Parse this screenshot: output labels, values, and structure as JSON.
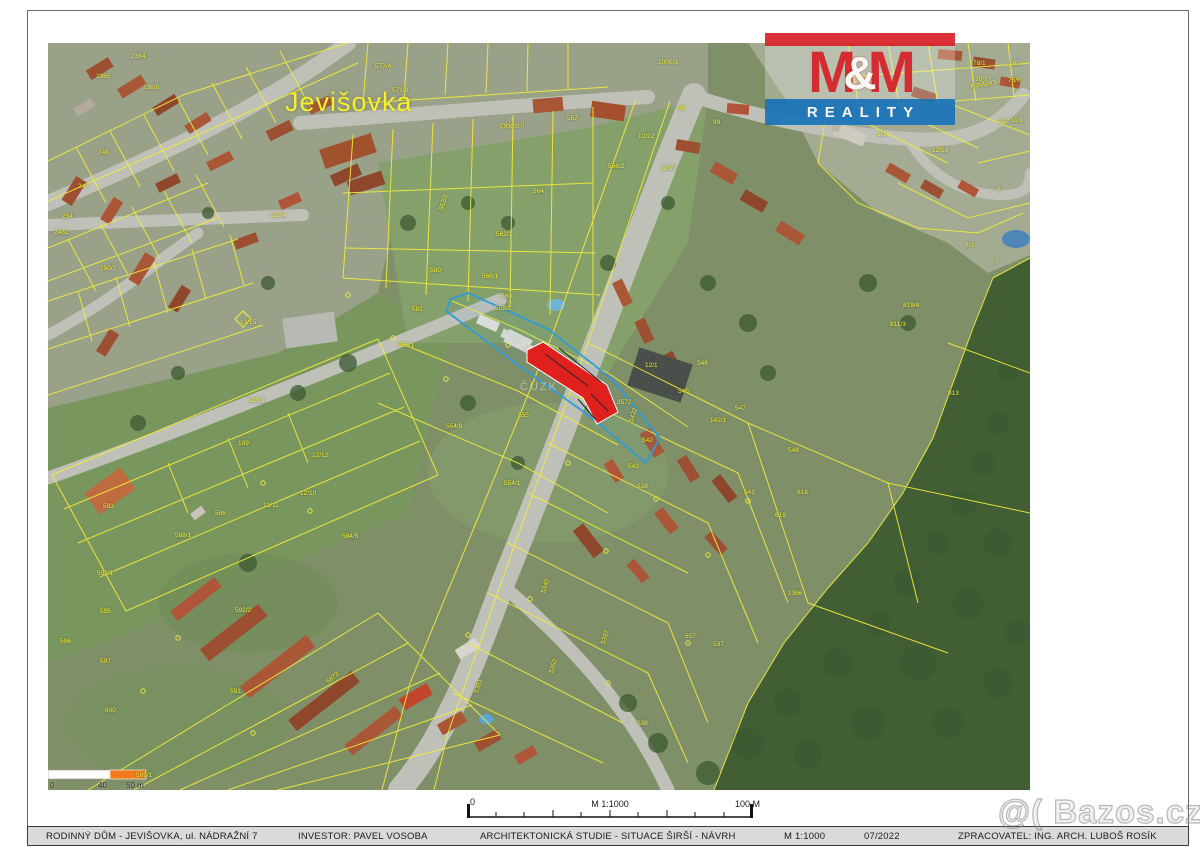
{
  "logo": {
    "m_left": "M",
    "amp": "&",
    "m_right": "M",
    "reality": "REALITY",
    "red": "#d8232a",
    "blue": "#1b75bb"
  },
  "map": {
    "town_label": "Jevišovka",
    "cuzk_watermark": "ČÚZK",
    "colors": {
      "cadastral_line": "#f2ec3a",
      "subject_fill": "#e0201c",
      "boundary_blue": "#2f9cd8",
      "scalebar_orange": "#ef7b1e"
    },
    "street_labels": [
      {
        "t": "Obecní",
        "x": 452,
        "y": 78,
        "r": -3
      },
      {
        "t": "Kostelní",
        "x": 922,
        "y": 36,
        "r": -10
      }
    ],
    "parcels": [
      {
        "t": "2364",
        "x": 83,
        "y": 10
      },
      {
        "t": "2365",
        "x": 48,
        "y": 30
      },
      {
        "t": "236/8",
        "x": 95,
        "y": 41
      },
      {
        "t": "248",
        "x": 50,
        "y": 106
      },
      {
        "t": "247",
        "x": 30,
        "y": 140
      },
      {
        "t": "2431",
        "x": 6,
        "y": 186
      },
      {
        "t": "254",
        "x": 14,
        "y": 170
      },
      {
        "t": "250/2",
        "x": 52,
        "y": 222
      },
      {
        "t": "12/24",
        "x": 222,
        "y": 169
      },
      {
        "t": "13/15",
        "x": 192,
        "y": 276
      },
      {
        "t": "577/4",
        "x": 327,
        "y": 20
      },
      {
        "t": "571/8",
        "x": 344,
        "y": 44
      },
      {
        "t": "1000/3",
        "x": 610,
        "y": 16
      },
      {
        "t": "98",
        "x": 630,
        "y": 62
      },
      {
        "t": "99",
        "x": 665,
        "y": 76
      },
      {
        "t": "557",
        "x": 519,
        "y": 72
      },
      {
        "t": "12/22",
        "x": 590,
        "y": 90
      },
      {
        "t": "566/2",
        "x": 560,
        "y": 120
      },
      {
        "t": "120/2",
        "x": 612,
        "y": 122
      },
      {
        "t": "564",
        "x": 485,
        "y": 145
      },
      {
        "t": "562/1",
        "x": 448,
        "y": 188
      },
      {
        "t": "566/1",
        "x": 434,
        "y": 230
      },
      {
        "t": "580",
        "x": 382,
        "y": 224
      },
      {
        "t": "562/2",
        "x": 390,
        "y": 166,
        "r": -72
      },
      {
        "t": "582",
        "x": 364,
        "y": 263
      },
      {
        "t": "560",
        "x": 453,
        "y": 250
      },
      {
        "t": "558/2",
        "x": 447,
        "y": 262
      },
      {
        "t": "555/1",
        "x": 350,
        "y": 299
      },
      {
        "t": "555",
        "x": 470,
        "y": 369
      },
      {
        "t": "554/9",
        "x": 398,
        "y": 380
      },
      {
        "t": "554/1",
        "x": 456,
        "y": 437
      },
      {
        "t": "12/1",
        "x": 597,
        "y": 319
      },
      {
        "t": "3572",
        "x": 569,
        "y": 356
      },
      {
        "t": "5432",
        "x": 580,
        "y": 378,
        "r": -72
      },
      {
        "t": "542",
        "x": 594,
        "y": 394
      },
      {
        "t": "543",
        "x": 580,
        "y": 420
      },
      {
        "t": "142/1",
        "x": 662,
        "y": 374
      },
      {
        "t": "545",
        "x": 630,
        "y": 345
      },
      {
        "t": "546",
        "x": 649,
        "y": 317
      },
      {
        "t": "547",
        "x": 687,
        "y": 362
      },
      {
        "t": "548",
        "x": 740,
        "y": 404
      },
      {
        "t": "538",
        "x": 589,
        "y": 440
      },
      {
        "t": "541",
        "x": 696,
        "y": 446
      },
      {
        "t": "618",
        "x": 749,
        "y": 446
      },
      {
        "t": "619",
        "x": 727,
        "y": 469
      },
      {
        "t": "1366",
        "x": 740,
        "y": 547
      },
      {
        "t": "557",
        "x": 637,
        "y": 590
      },
      {
        "t": "537",
        "x": 665,
        "y": 598
      },
      {
        "t": "538",
        "x": 589,
        "y": 677
      },
      {
        "t": "5397",
        "x": 552,
        "y": 600,
        "r": -72
      },
      {
        "t": "5340",
        "x": 492,
        "y": 549,
        "r": -72
      },
      {
        "t": "5352",
        "x": 500,
        "y": 629,
        "r": -72
      },
      {
        "t": "5361",
        "x": 425,
        "y": 649,
        "r": -72
      },
      {
        "t": "12/13",
        "x": 200,
        "y": 354
      },
      {
        "t": "189",
        "x": 190,
        "y": 397
      },
      {
        "t": "12/12",
        "x": 264,
        "y": 409
      },
      {
        "t": "12/10",
        "x": 252,
        "y": 447
      },
      {
        "t": "12/11",
        "x": 215,
        "y": 459
      },
      {
        "t": "586",
        "x": 167,
        "y": 467
      },
      {
        "t": "588/1",
        "x": 127,
        "y": 489
      },
      {
        "t": "583",
        "x": 55,
        "y": 460
      },
      {
        "t": "584/5",
        "x": 294,
        "y": 490
      },
      {
        "t": "592/1",
        "x": 49,
        "y": 527
      },
      {
        "t": "592/2",
        "x": 187,
        "y": 564
      },
      {
        "t": "595",
        "x": 52,
        "y": 565
      },
      {
        "t": "596",
        "x": 12,
        "y": 595
      },
      {
        "t": "597",
        "x": 52,
        "y": 615
      },
      {
        "t": "600",
        "x": 57,
        "y": 664
      },
      {
        "t": "591",
        "x": 182,
        "y": 645
      },
      {
        "t": "5673",
        "x": 277,
        "y": 637,
        "r": -40
      },
      {
        "t": "599/1",
        "x": 88,
        "y": 729
      },
      {
        "t": "78/1",
        "x": 925,
        "y": 17
      },
      {
        "t": "76/1",
        "x": 961,
        "y": 17
      },
      {
        "t": "78/2",
        "x": 927,
        "y": 33
      },
      {
        "t": "76/6",
        "x": 960,
        "y": 34
      },
      {
        "t": "11/2",
        "x": 949,
        "y": 75
      },
      {
        "t": "11/1",
        "x": 963,
        "y": 74
      },
      {
        "t": "1/1",
        "x": 829,
        "y": 88
      },
      {
        "t": "12/18",
        "x": 884,
        "y": 104
      },
      {
        "t": "6",
        "x": 949,
        "y": 143
      },
      {
        "t": "7",
        "x": 947,
        "y": 215
      },
      {
        "t": "8/1",
        "x": 917,
        "y": 199
      },
      {
        "t": "819/4",
        "x": 855,
        "y": 259
      },
      {
        "t": "811/3",
        "x": 842,
        "y": 278
      },
      {
        "t": "813",
        "x": 900,
        "y": 347
      }
    ]
  },
  "scalebar_map": {
    "start": "0",
    "mid": "40",
    "end": "50 m"
  },
  "scalebar_drawing": {
    "start": "0",
    "scale": "M 1:1000",
    "end": "100 M"
  },
  "titleblock": {
    "project": "RODINNÝ DŮM - JEVIŠOVKA, ul. NÁDRAŽNÍ 7",
    "investor": "INVESTOR: PAVEL VOSOBA",
    "drawing": "ARCHITEKTONICKÁ STUDIE - SITUACE ŠIRŠÍ - NÁVRH",
    "scale": "M 1:1000",
    "date": "07/2022",
    "author": "ZPRACOVATEL: ING. ARCH. LUBOŠ ROSÍK"
  },
  "watermark": {
    "text": "@( Bazos.cz"
  }
}
